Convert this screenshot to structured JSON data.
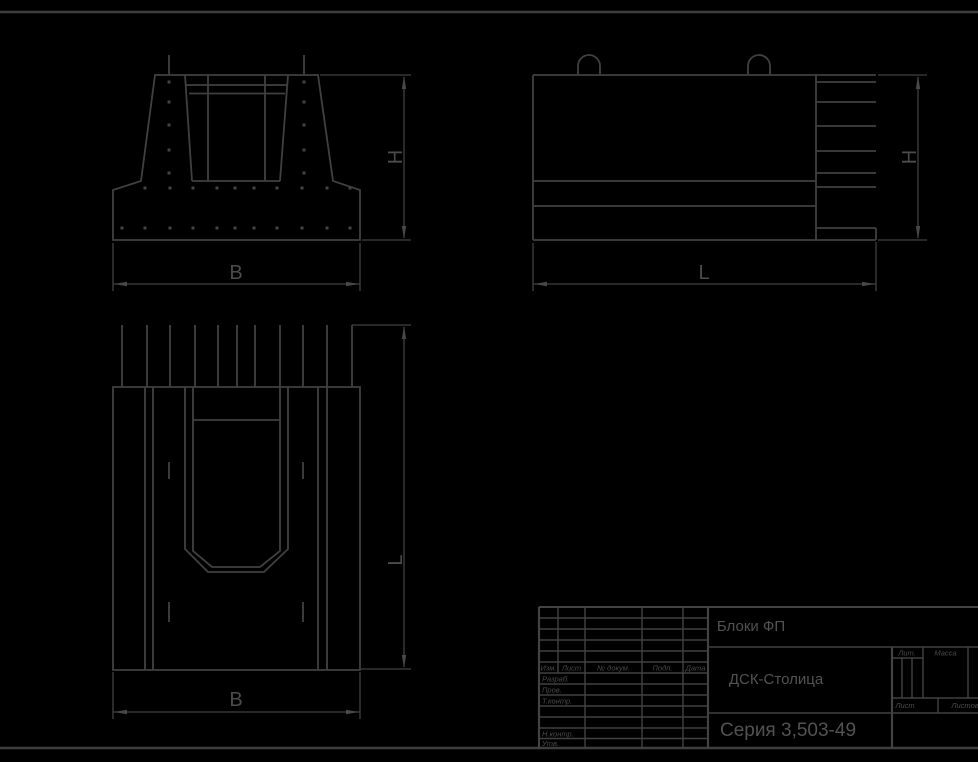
{
  "sheet": {
    "background_color": "#000000",
    "line_color": "#404040",
    "text_color": "#4c4c4c"
  },
  "views": {
    "front": {
      "width_label": "B",
      "height_label": "H"
    },
    "side": {
      "length_label": "L",
      "height_label": "H"
    },
    "plan": {
      "width_label": "B",
      "length_label": "L"
    }
  },
  "title_block": {
    "product_title": "Блоки ФП",
    "organization": "ДСК-Столица",
    "series": "Серия 3,503-49",
    "header_columns": [
      "Изм.",
      "Лист",
      "№ докум.",
      "Подп.",
      "Дата"
    ],
    "signature_rows": [
      "Разраб.",
      "Пров.",
      "Т.контр.",
      "Н.контр.",
      "Утв."
    ],
    "right_section": {
      "lit": "Лит.",
      "mass": "Масса",
      "scale": "Масштаб",
      "sheet": "Лист",
      "sheets": "Листов"
    }
  }
}
